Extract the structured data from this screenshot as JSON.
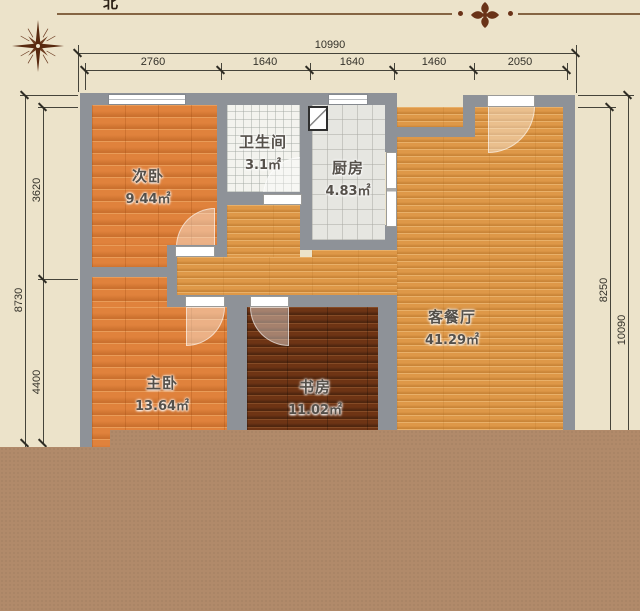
{
  "compass": {
    "north_label": "北"
  },
  "rooms": [
    {
      "id": "bedroom2",
      "name": "次卧",
      "area": "9.44㎡"
    },
    {
      "id": "bathroom",
      "name": "卫生间",
      "area": "3.1㎡"
    },
    {
      "id": "kitchen",
      "name": "厨房",
      "area": "4.83㎡"
    },
    {
      "id": "living_dining",
      "name": "客餐厅",
      "area": "41.29㎡"
    },
    {
      "id": "master_bedroom",
      "name": "主卧",
      "area": "13.64㎡"
    },
    {
      "id": "study",
      "name": "书房",
      "area": "11.02㎡"
    }
  ],
  "dimensions": {
    "top_total": "10990",
    "top_segments": [
      "2760",
      "1640",
      "1640",
      "1460",
      "2050"
    ],
    "left_total": "8730",
    "left_segments": [
      "3620",
      "4400"
    ],
    "right_inner": "8250",
    "right_outer": "10090"
  },
  "colors": {
    "background": "#ece3ca",
    "wall": "#8e9298",
    "bedroom_floor": "#e0823c",
    "living_floor": "#de9848",
    "study_floor": "#6e3414",
    "bathroom_floor": "#f3f3ee",
    "kitchen_floor": "#e6e6e1",
    "bottom_band": "#b18a6a",
    "accent_line": "#856543"
  }
}
